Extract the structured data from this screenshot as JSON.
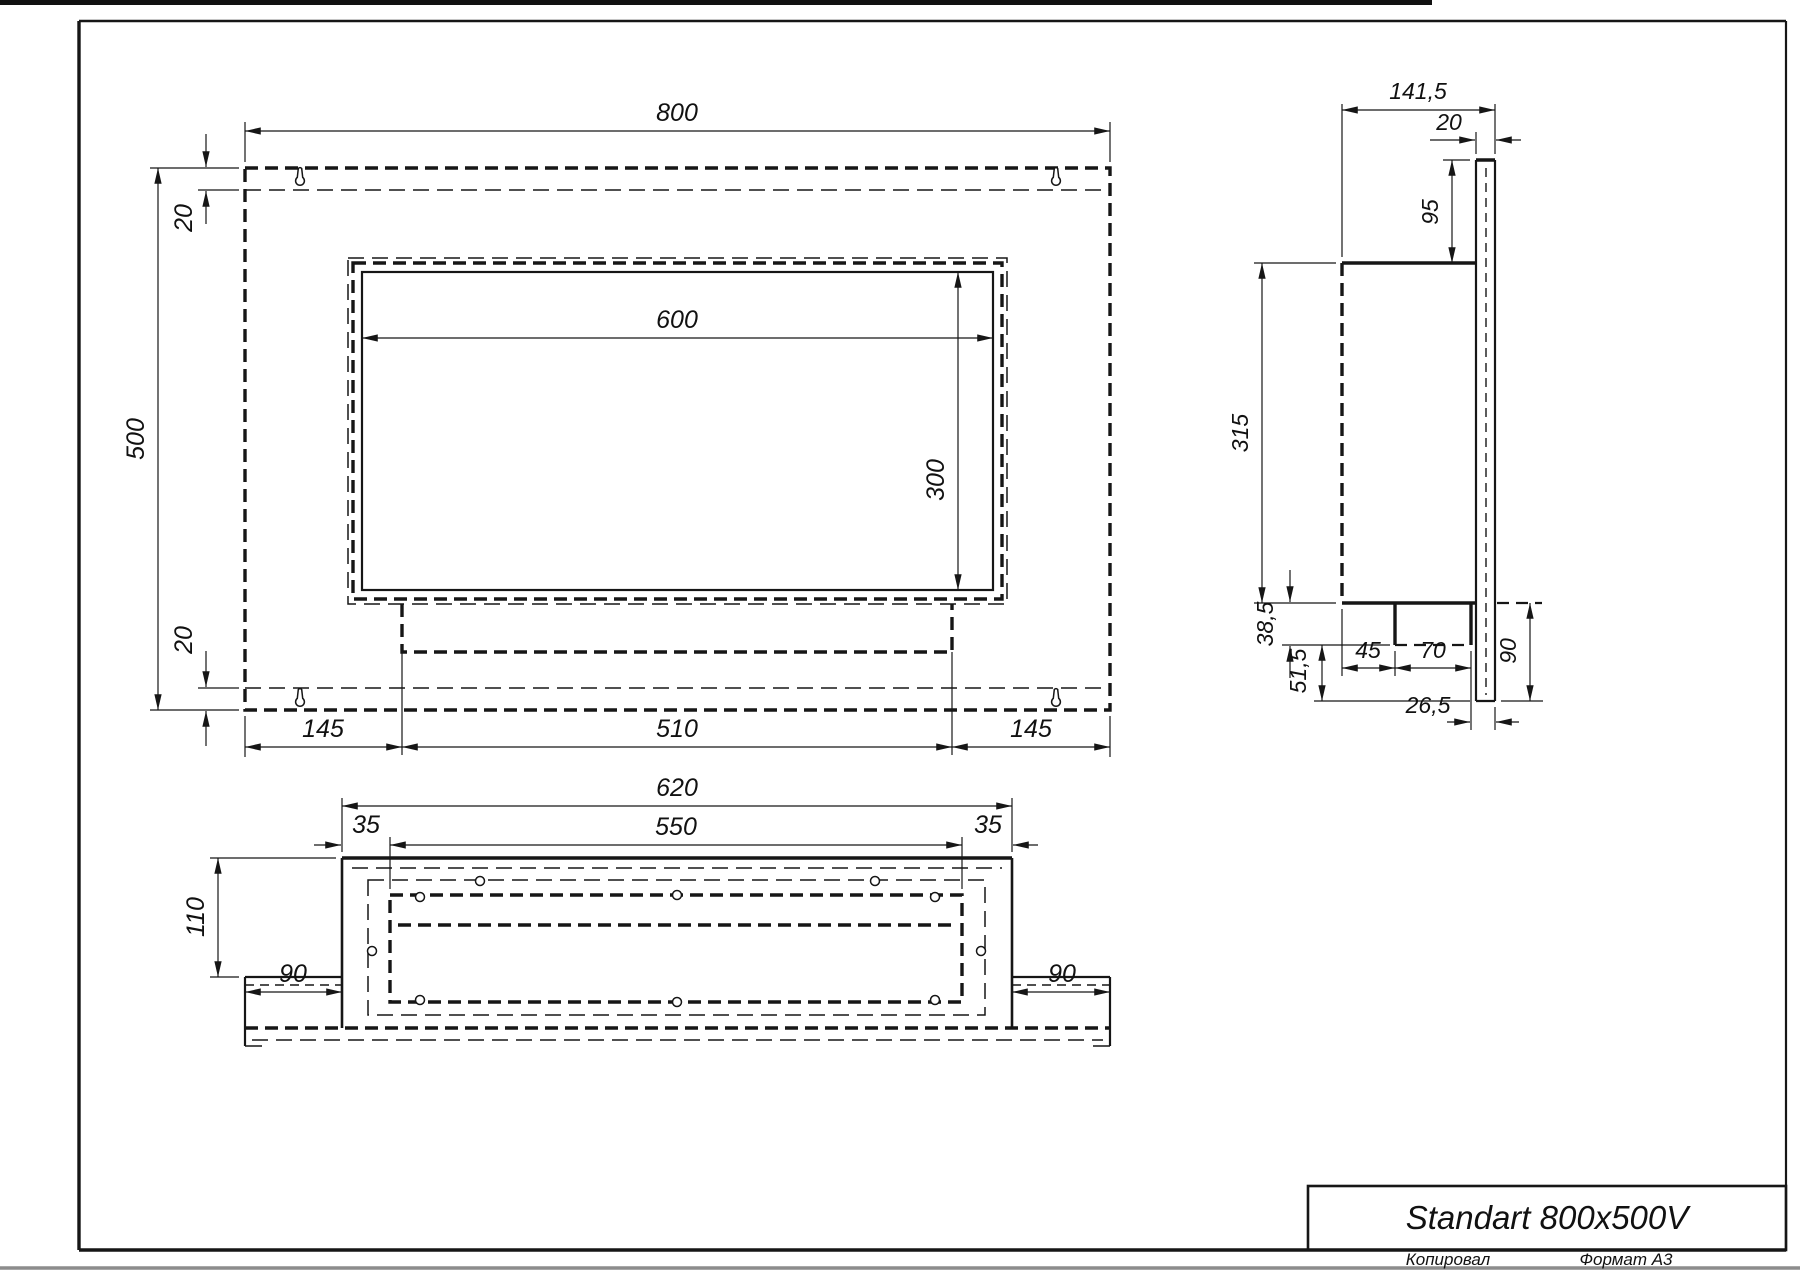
{
  "sheet": {
    "title": "Standart 800x500V",
    "stamp_copied": "Копировал",
    "stamp_format": "Формат A3"
  },
  "front_view": {
    "width": "800",
    "height": "500",
    "top_flange": "20",
    "bottom_flange": "20",
    "opening_width": "600",
    "opening_height": "300",
    "left_margin": "145",
    "tray_width": "510",
    "right_margin": "145"
  },
  "side_view": {
    "total_depth": "141,5",
    "plate_thickness": "20",
    "top_offset": "95",
    "body_height": "315",
    "step_a": "38,5",
    "step_b": "51,5",
    "burner_offset": "45",
    "burner_depth": "70",
    "bottom_lip": "26,5",
    "plate_drop": "90"
  },
  "bottom_view": {
    "body_width": "620",
    "tray_width": "550",
    "left_inset": "35",
    "right_inset": "35",
    "depth": "110",
    "left_wing": "90",
    "right_wing": "90"
  }
}
